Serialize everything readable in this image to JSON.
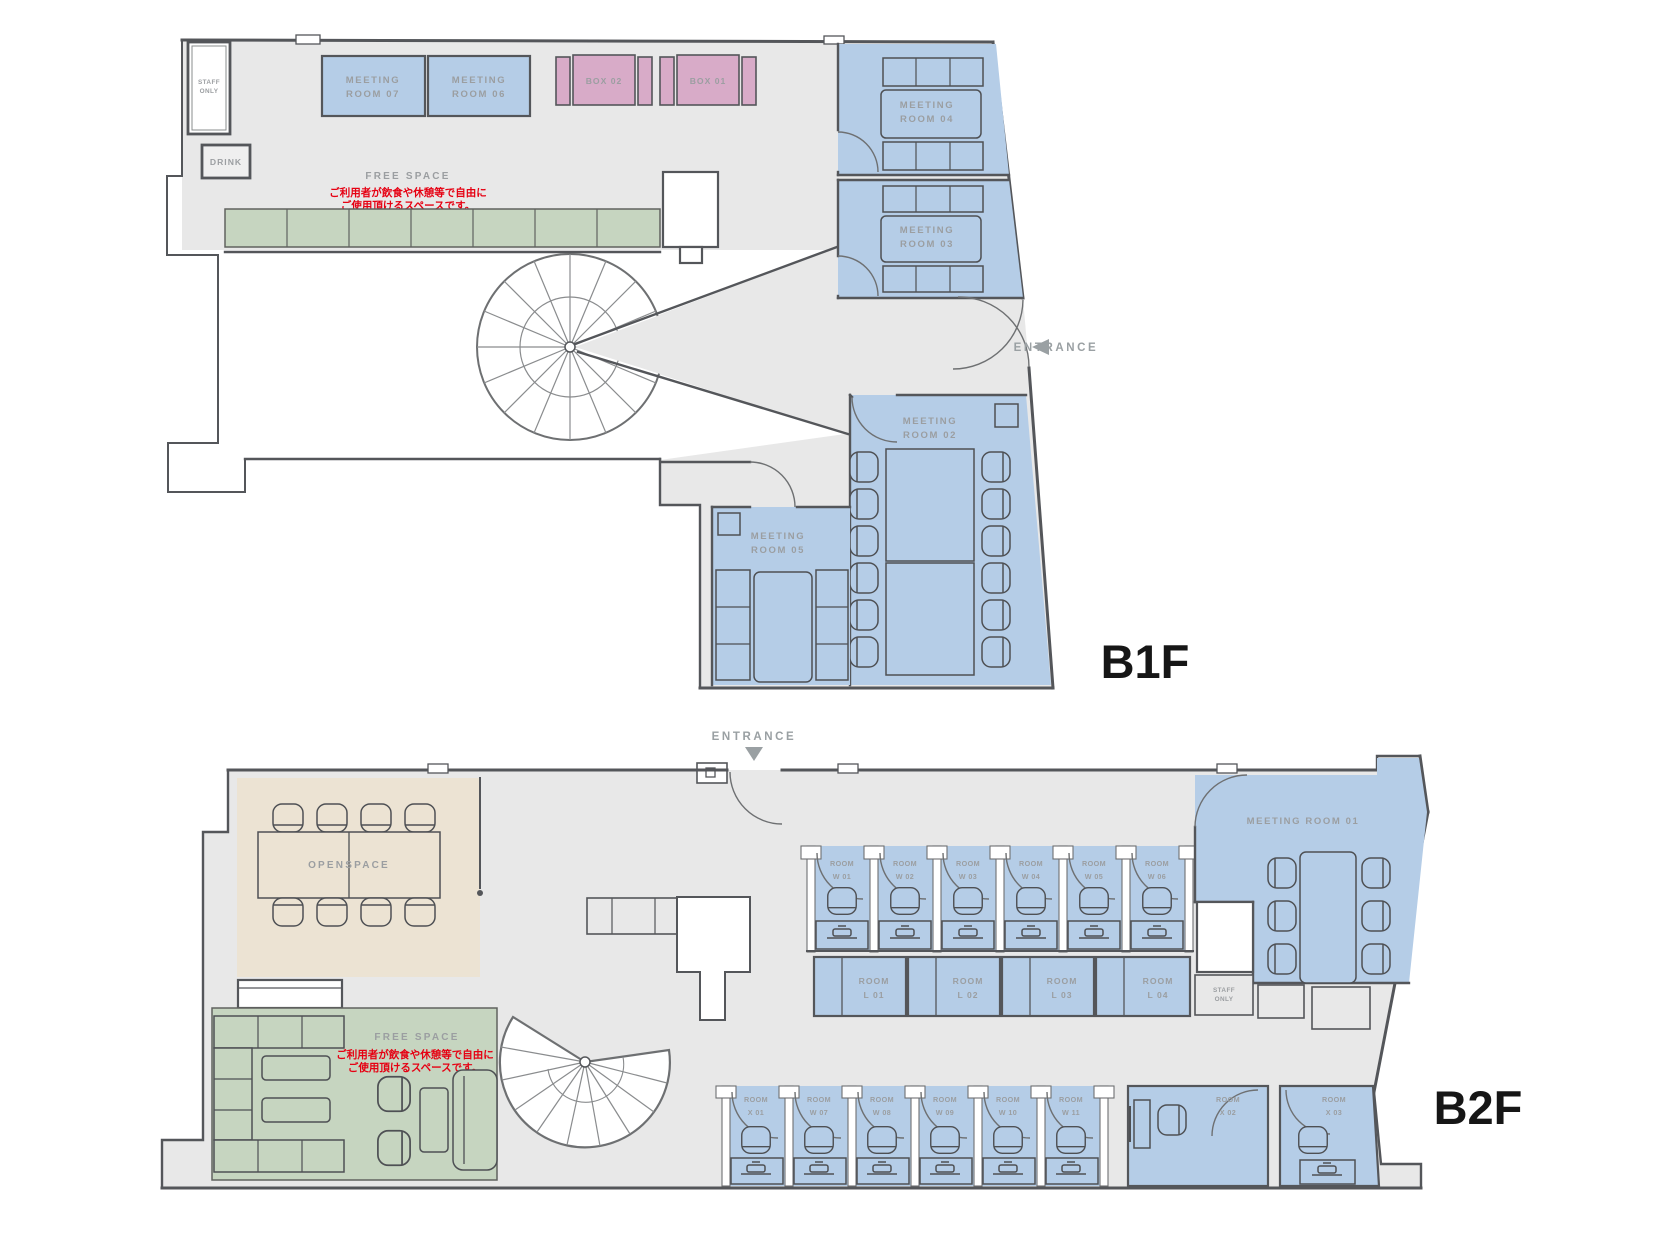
{
  "colors": {
    "floor": "#e8e8e8",
    "room_blue": "#b5cde7",
    "box_pink": "#d8abc8",
    "seat_green": "#c6d5c0",
    "open_beige": "#ece3d3",
    "wall": "#54565a",
    "label_gray": "#9b9ea1",
    "note_red": "#e60012",
    "floor_label_black": "#161616"
  },
  "b1f": {
    "label": "B1F",
    "entrance": "ENTRANCE",
    "staff1": "STAFF",
    "staff2": "ONLY",
    "drink": "DRINK",
    "freespace": "FREE SPACE",
    "note1": "ご利用者が飲食や休憩等で自由に",
    "note2": "ご使用頂けるスペースです。",
    "box02": "BOX 02",
    "box01": "BOX 01",
    "rooms": {
      "m07": [
        "MEETING",
        "ROOM 07"
      ],
      "m06": [
        "MEETING",
        "ROOM 06"
      ],
      "m05": [
        "MEETING",
        "ROOM 05"
      ],
      "m04": [
        "MEETING",
        "ROOM 04"
      ],
      "m03": [
        "MEETING",
        "ROOM 03"
      ],
      "m02": [
        "MEETING",
        "ROOM 02"
      ]
    }
  },
  "b2f": {
    "label": "B2F",
    "entrance": "ENTRANCE",
    "openspace": "OPENSPACE",
    "freespace": "FREE SPACE",
    "note1": "ご利用者が飲食や休憩等で自由に",
    "note2": "ご使用頂けるスペースです。",
    "m01": "MEETING ROOM  01",
    "staff1": "STAFF",
    "staff2": "ONLY",
    "w_top": [
      [
        "ROOM",
        "W 01"
      ],
      [
        "ROOM",
        "W 02"
      ],
      [
        "ROOM",
        "W 03"
      ],
      [
        "ROOM",
        "W 04"
      ],
      [
        "ROOM",
        "W 05"
      ],
      [
        "ROOM",
        "W 06"
      ]
    ],
    "l_row": [
      [
        "ROOM",
        "L 01"
      ],
      [
        "ROOM",
        "L 02"
      ],
      [
        "ROOM",
        "L 03"
      ],
      [
        "ROOM",
        "L 04"
      ]
    ],
    "bottom": [
      [
        "ROOM",
        "X 01"
      ],
      [
        "ROOM",
        "W 07"
      ],
      [
        "ROOM",
        "W 08"
      ],
      [
        "ROOM",
        "W 09"
      ],
      [
        "ROOM",
        "W 10"
      ],
      [
        "ROOM",
        "W 11"
      ]
    ],
    "x2": [
      "ROOM",
      "X 02"
    ],
    "x3": [
      "ROOM",
      "X 03"
    ]
  }
}
